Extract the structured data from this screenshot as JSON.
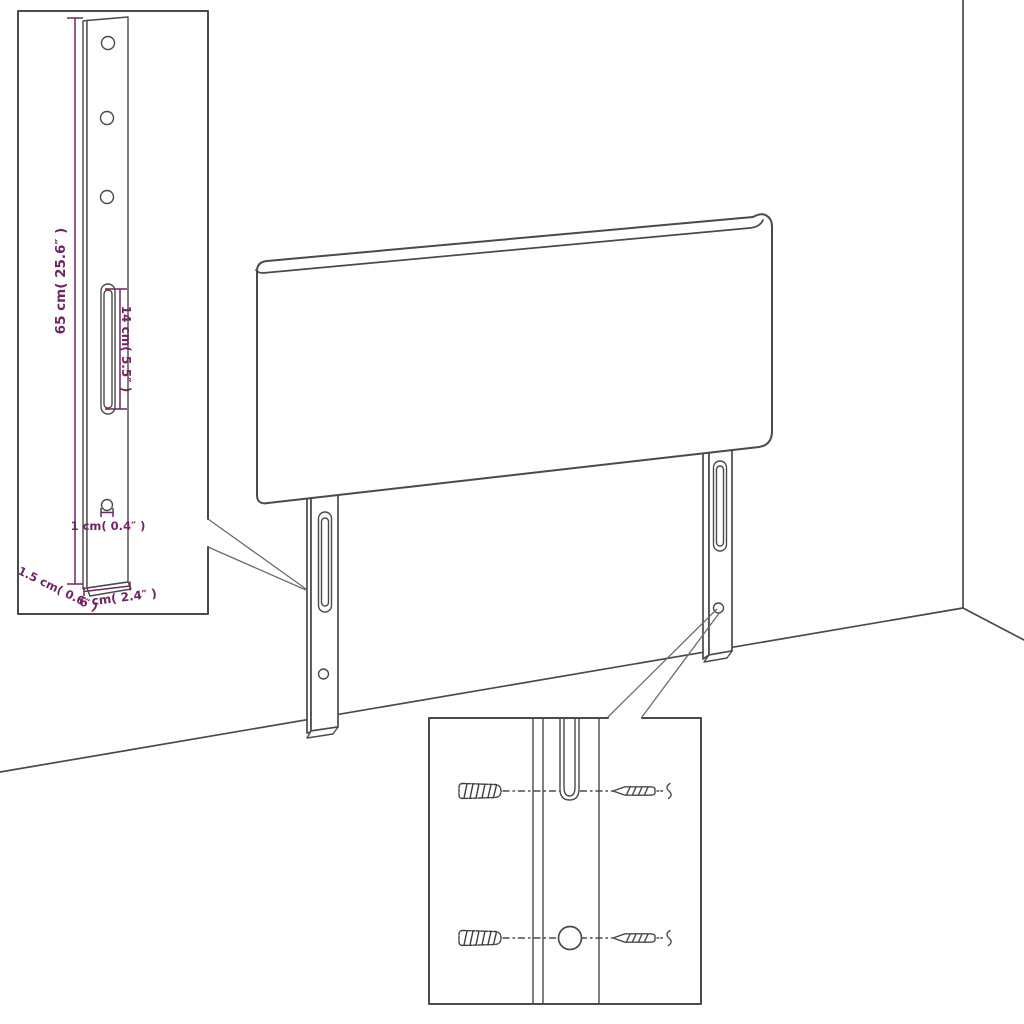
{
  "colors": {
    "outline": "#4a4a4a",
    "dimension": "#702562",
    "background": "#ffffff"
  },
  "dimensions": {
    "bracket_height": "65 cm( 25.6″ )",
    "slot_length": "14 cm( 5.5″ )",
    "hole_diameter": "1 cm( 0.4″ )",
    "bracket_depth": "1.5 cm( 0.6″ )",
    "bracket_width": "6 cm( 2.4″ )"
  },
  "icons": {
    "wall_plug": "wall-plug-icon",
    "screw": "screw-icon",
    "slot": "mounting-slot",
    "hole": "screw-hole"
  }
}
